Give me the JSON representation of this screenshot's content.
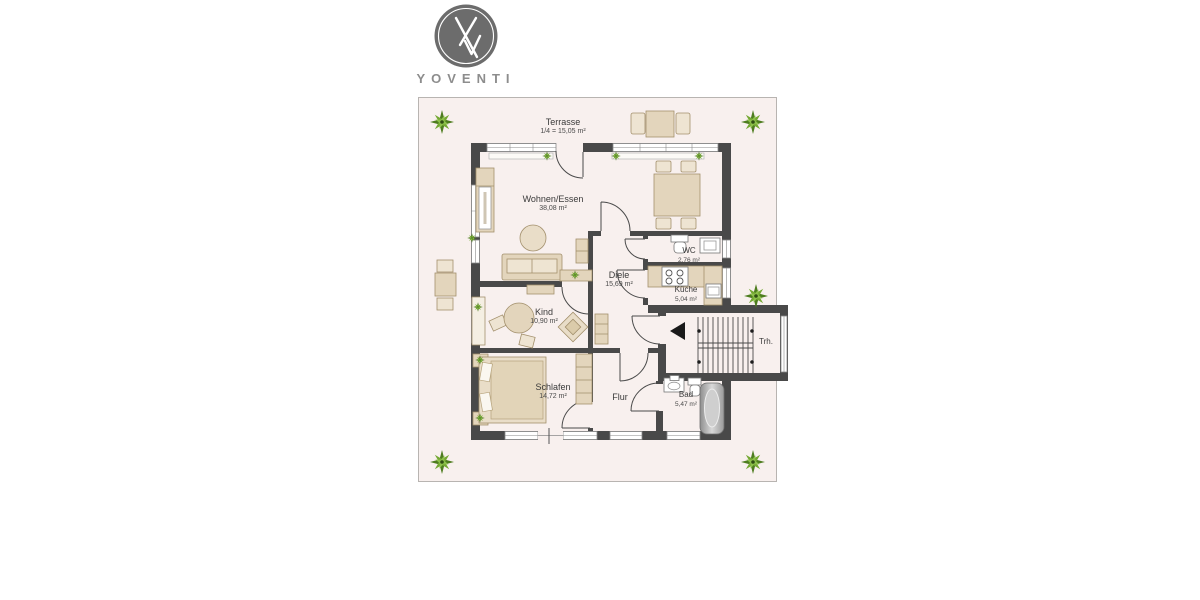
{
  "logo": {
    "brand": "YOVENTI",
    "monogram": "Yv-monogram"
  },
  "plan": {
    "terrace": {
      "name": "Terrasse",
      "area": "1/4 = 15,05 m²"
    },
    "rooms": [
      {
        "id": "wohnen-essen",
        "name": "Wohnen/Essen",
        "area": "38,08 m²"
      },
      {
        "id": "diele",
        "name": "Diele",
        "area": "15,69 m²"
      },
      {
        "id": "wc",
        "name": "WC",
        "area": "2,76 m²"
      },
      {
        "id": "kueche",
        "name": "Küche",
        "area": "5,04 m²"
      },
      {
        "id": "kind",
        "name": "Kind",
        "area": "10,90 m²"
      },
      {
        "id": "schlafen",
        "name": "Schlafen",
        "area": "14,72 m²"
      },
      {
        "id": "flur",
        "name": "Flur"
      },
      {
        "id": "bad",
        "name": "Bad",
        "area": "5,47 m²"
      },
      {
        "id": "treppenhaus",
        "name": "Trh."
      }
    ],
    "colors": {
      "wall": "#494949",
      "floor": "#f8f0ee",
      "furniture": "#e3d5bc",
      "furniture_light": "#eee4d2",
      "plant_green": "#74a832",
      "logo_gray": "#6c6c6c"
    }
  }
}
